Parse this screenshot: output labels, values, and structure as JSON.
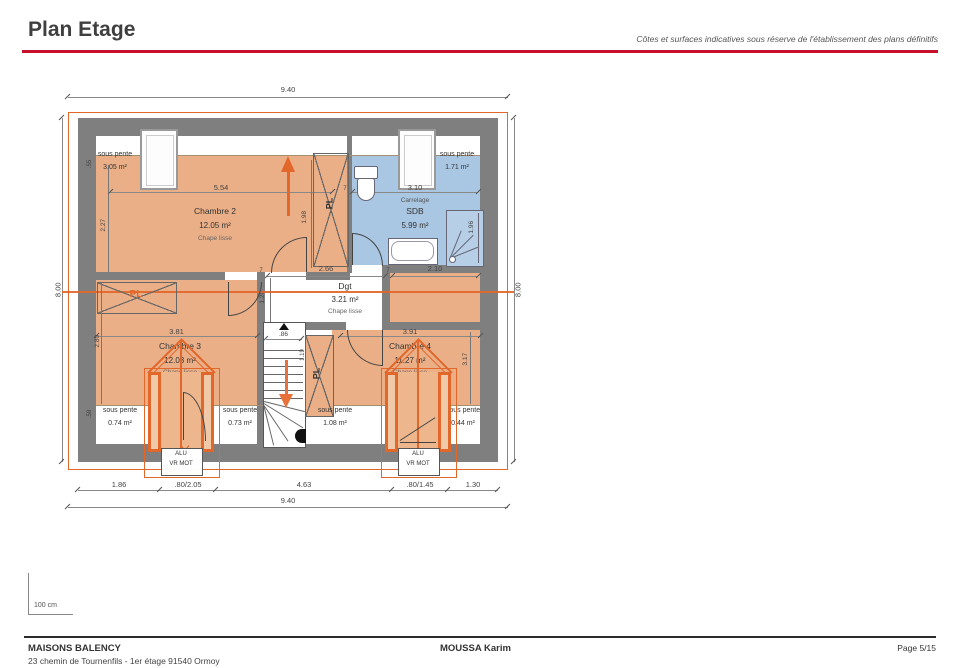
{
  "header": {
    "title": "Plan Etage",
    "disclaimer": "Côtes et surfaces indicatives sous réserve de l'établissement des plans définitifs"
  },
  "dims": {
    "width_top": "9.40",
    "width_bottom": "9.40",
    "height_left": "8.00",
    "height_right": "8.00",
    "bottom_seg_1": "1.86",
    "bottom_seg_2": ".80/2.05",
    "bottom_seg_3": "4.63",
    "bottom_seg_4": ".80/1.45",
    "bottom_seg_5": "1.30",
    "chambre2_w": "5.54",
    "sdb_w": "3.10",
    "dgt_w": "2.66",
    "sdb_bottom_w": "2.10",
    "chambre3_w": "3.81",
    "chambre4_w": "3.91",
    "chambre2_h": "2.27",
    "pl_top_h": "1.98",
    "dgt_h": "1.20",
    "stair_w": ".86",
    "pl_mid_h": "1.19",
    "shower_h": "1.96",
    "chambre3_h": "2.80",
    "chambre4_h": "3.17",
    "sp_top_h": ".55",
    "sp_bottom_h": ".58",
    "wall_t1": "7",
    "wall_t2": "7",
    "wall_t3": "7"
  },
  "rooms": {
    "chambre2": {
      "name": "Chambre 2",
      "area": "12.05 m²",
      "floor": "Chape lisse"
    },
    "sdb": {
      "finish": "Carrelage",
      "name": "SDB",
      "area": "5.99 m²"
    },
    "dgt": {
      "name": "Dgt",
      "area": "3.21 m²",
      "floor": "Chape lisse"
    },
    "chambre3": {
      "name": "Chambre 3",
      "area": "12.03 m²",
      "floor": "Chape lisse"
    },
    "chambre4": {
      "name": "Chambre 4",
      "area": "11.27 m²",
      "floor": "Chape lisse"
    }
  },
  "sous_pente": {
    "label": "sous pente",
    "area_top_left": "3.05 m²",
    "area_top_right": "1.71 m²",
    "area_bottom_left": "0.74 m²",
    "area_bottom_mid_left": "0.73 m²",
    "area_bottom_mid_right": "1.08 m²",
    "area_bottom_right": "0.44 m²"
  },
  "closets": {
    "label": "PL"
  },
  "dormer_window": {
    "line1": "ALU",
    "line2": "VR MOT"
  },
  "scale": {
    "label": "100 cm"
  },
  "footer": {
    "company": "MAISONS BALENCY",
    "address": "23 chemin de Tournenfils - 1er étage 91540 Ormoy",
    "client": "MOUSSA Karim",
    "page": "Page 5/15"
  },
  "colors": {
    "accent_red": "#c8102e",
    "plan_orange": "#e2672a",
    "room_fill": "#eaaf87",
    "wet_fill": "#a9c6e2",
    "wall": "#7f7f7f"
  }
}
